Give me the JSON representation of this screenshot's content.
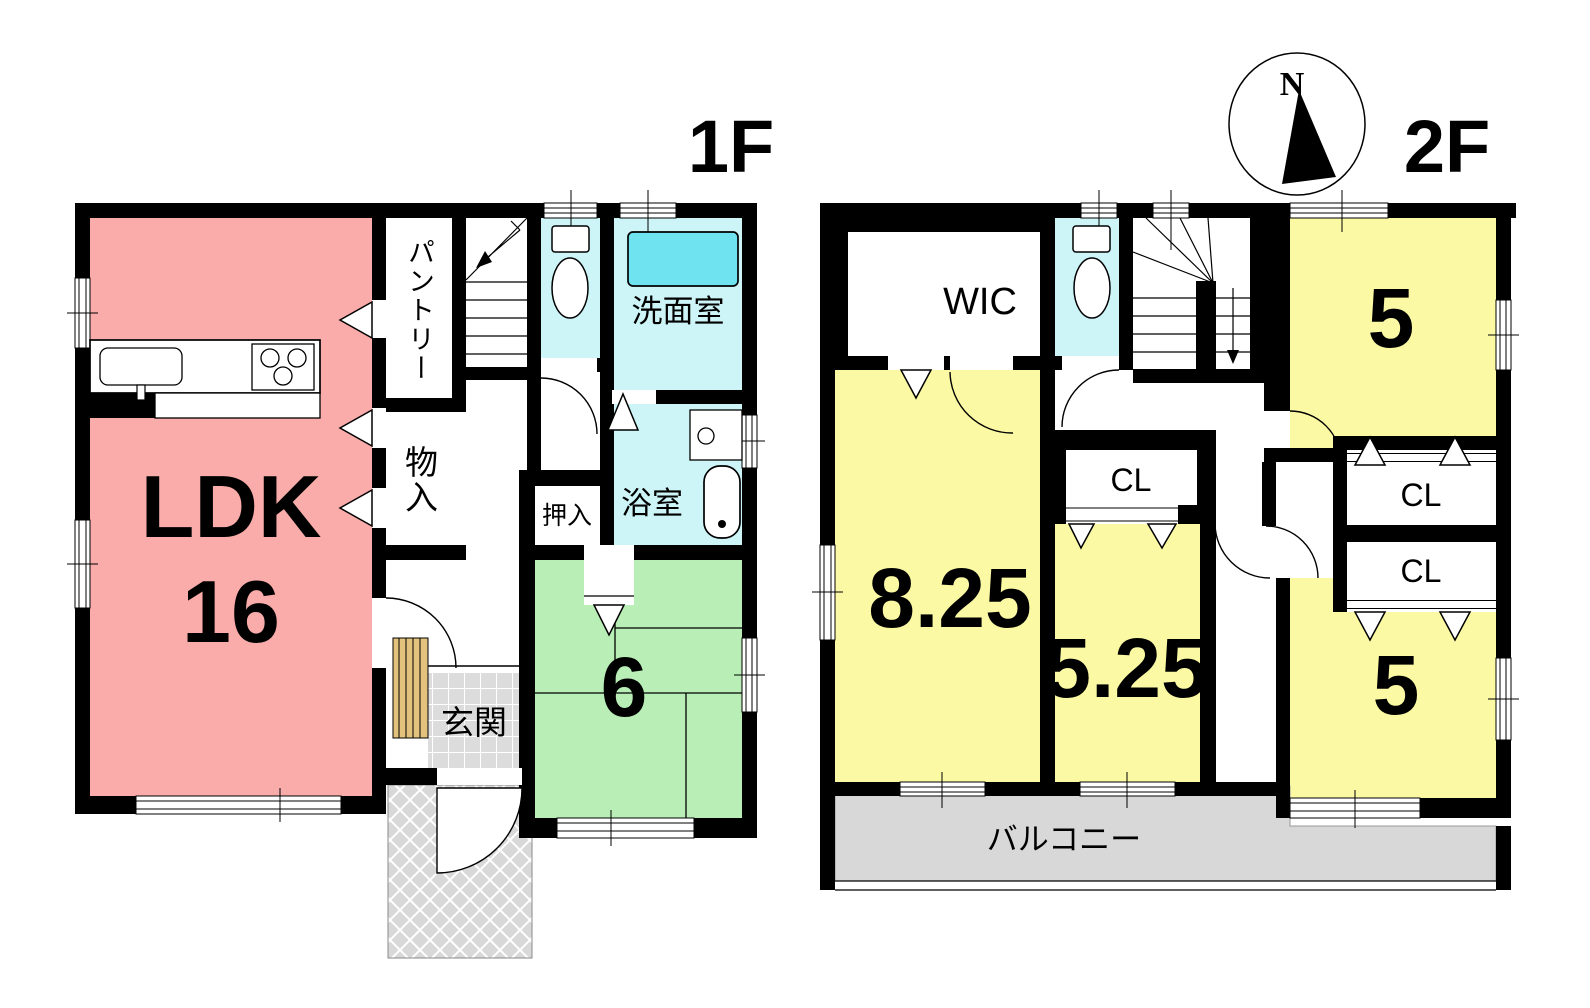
{
  "floor1": {
    "label": "1F",
    "ldk": "LDK",
    "ldk_size": "16",
    "pantry": "パントリー",
    "storage": "物入",
    "oshiire": "押入",
    "washroom": "洗面室",
    "bathroom": "浴室",
    "genkan": "玄関",
    "tatami_size": "6"
  },
  "floor2": {
    "label": "2F",
    "compass_north": "N",
    "wic": "WIC",
    "room_large": "8.25",
    "room_middle": "5.25",
    "room_top_right": "5",
    "room_bottom_right": "5",
    "closet_middle": "CL",
    "closet_upper": "CL",
    "closet_lower": "CL",
    "balcony": "バルコニー"
  },
  "colors": {
    "wall": "#000000",
    "ldk_pink": "#F9ACA9",
    "tatami_green": "#B9EFB6",
    "wet_cyan": "#CDF5F7",
    "fixture_cyan": "#6FE3F0",
    "bedroom_yellow": "#FBF9A3",
    "balcony_gray": "#D8D8D8",
    "tile_gray": "#DCDCDC",
    "wood_tan": "#E3C27D"
  }
}
